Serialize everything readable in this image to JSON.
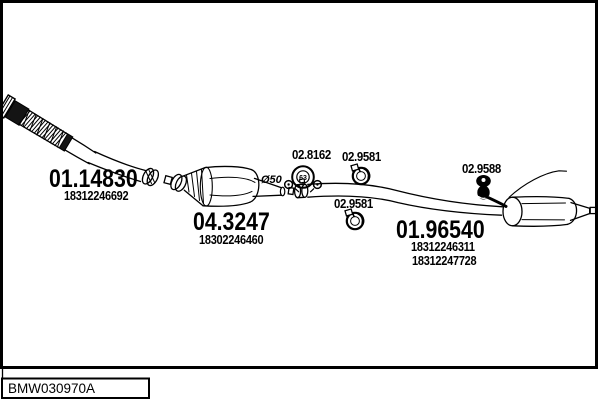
{
  "page": {
    "background": "#ffffff",
    "ink": "#000000"
  },
  "code_box": {
    "text": "BMW030970A"
  },
  "parts": {
    "front_flex_pipe": {
      "code": "01.14830",
      "oem_number": "18312246692"
    },
    "catalytic_converter": {
      "code": "04.3247",
      "oem_number": "18302246460"
    },
    "rear_silencer": {
      "code": "01.96540",
      "oem_number_1": "18312246311",
      "oem_number_2": "18312247728"
    },
    "flange_gasket": {
      "code": "02.8162",
      "icon_text": "63"
    },
    "clamp_front": {
      "code": "02.9581"
    },
    "clamp_rear": {
      "code": "02.9581"
    },
    "rubber_hanger": {
      "code": "02.9588"
    },
    "pipe_diameter_label": "Ø50"
  }
}
